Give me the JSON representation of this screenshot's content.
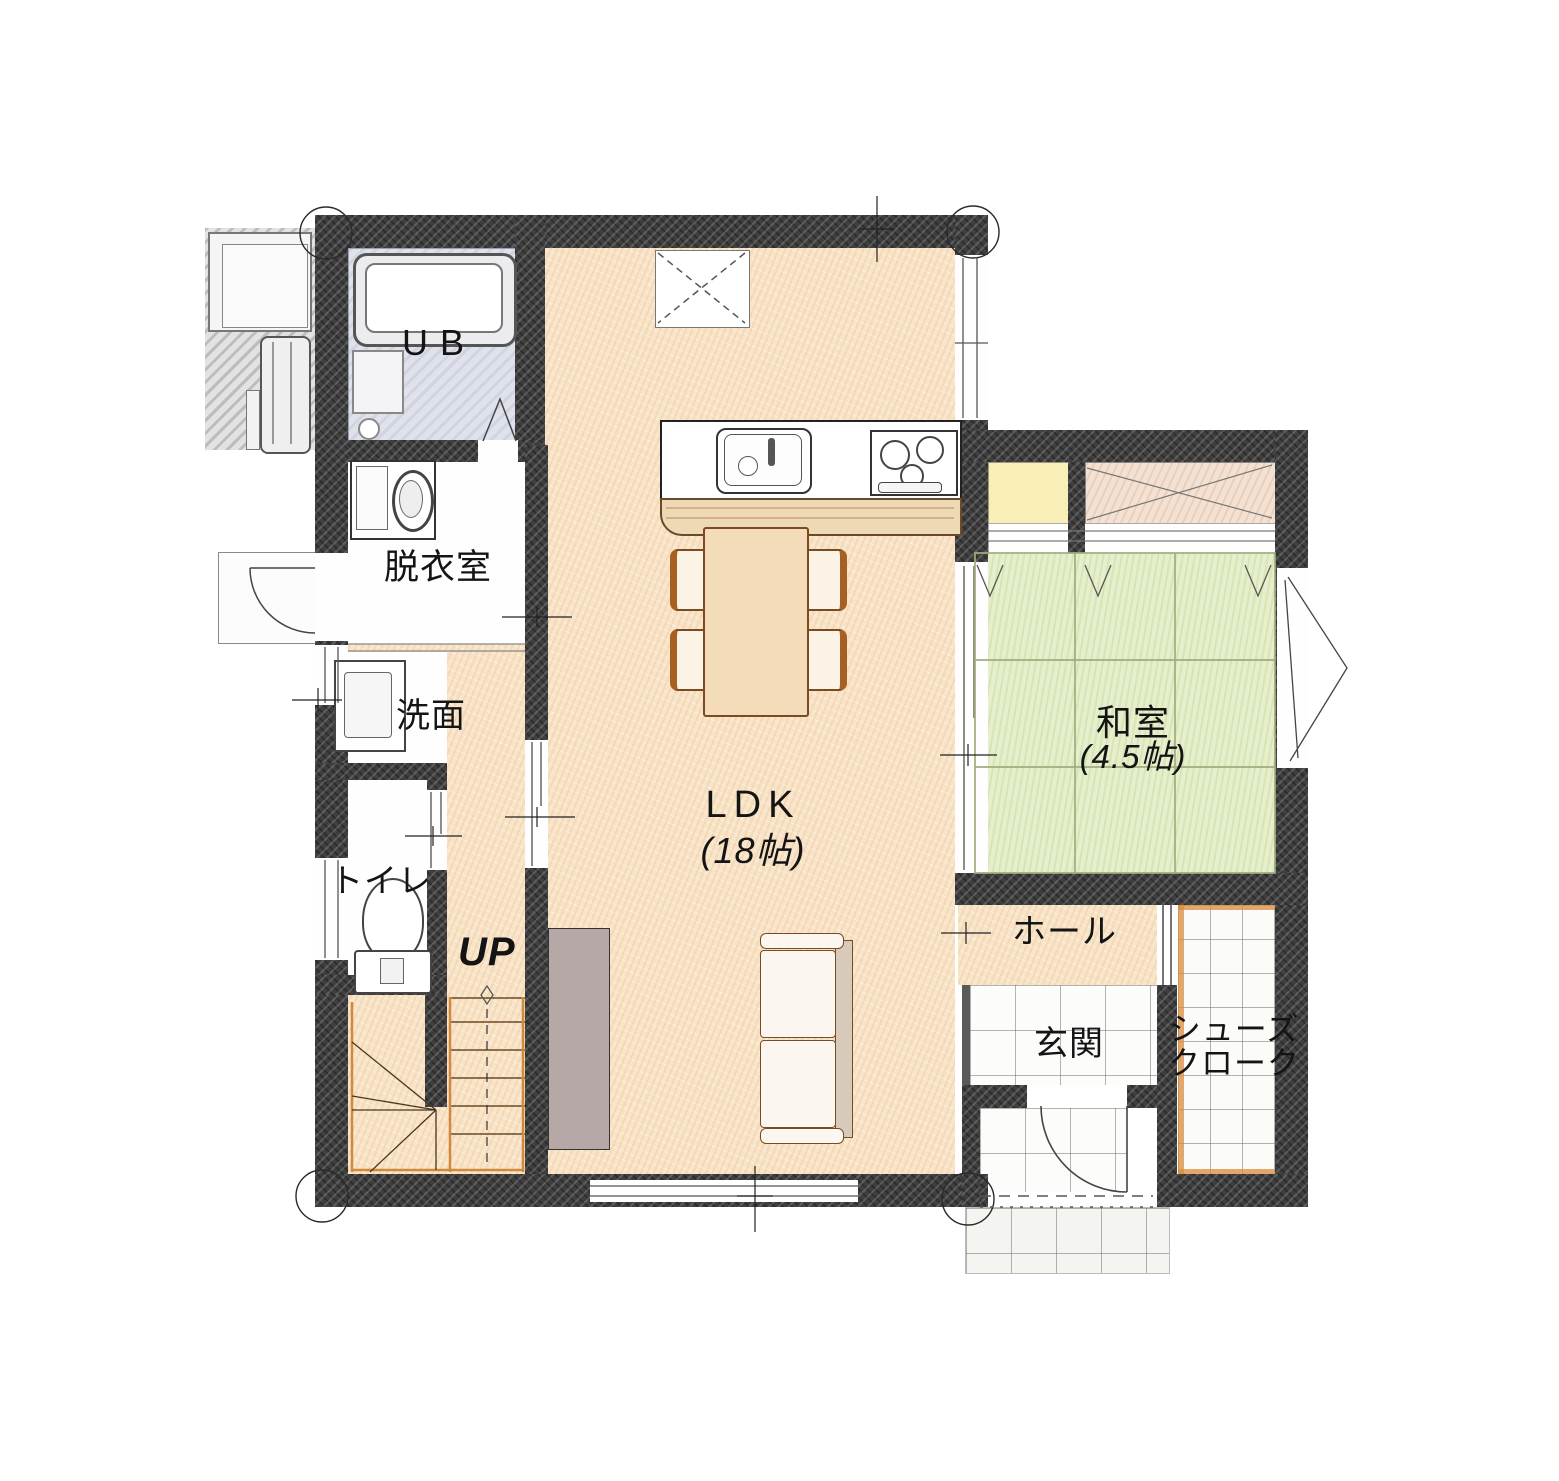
{
  "floorplan": {
    "type": "japanese-residential-first-floor-plan",
    "rooms": {
      "ub": {
        "label": "UB"
      },
      "dressing_room": {
        "label": "脱衣室"
      },
      "washroom": {
        "label": "洗面"
      },
      "toilet": {
        "label": "トイレ"
      },
      "stairs": {
        "label": "UP"
      },
      "ldk": {
        "label": "LDK",
        "size": "(18帖)"
      },
      "japanese_room": {
        "label": "和室",
        "size": "(4.5帖)"
      },
      "hall": {
        "label": "ホール"
      },
      "entrance": {
        "label": "玄関"
      },
      "shoe_closet": {
        "label_line1": "シューズ",
        "label_line2": "クローク"
      }
    },
    "fixtures": [
      "bathtub",
      "washing-machine",
      "washstand",
      "toilet-bowl",
      "kitchen-sink",
      "gas-stove",
      "refrigerator-space",
      "dining-table",
      "chair",
      "sofa",
      "tv-board",
      "staircase",
      "water-heater",
      "outdoor-equipment",
      "entry-door",
      "tatami-mats",
      "sliding-doors",
      "porch-tiles"
    ],
    "colors": {
      "wall": "#3f3f3f",
      "wood_floor": "#f8e5c9",
      "tatami": "#e5efcc",
      "tile": "#fcfcfa",
      "bath_floor": "#dfe2ea",
      "closet_yellow": "#f8eeb6",
      "closet_hatch": "#f3e2d3",
      "trim_orange": "#d98b3f"
    }
  }
}
